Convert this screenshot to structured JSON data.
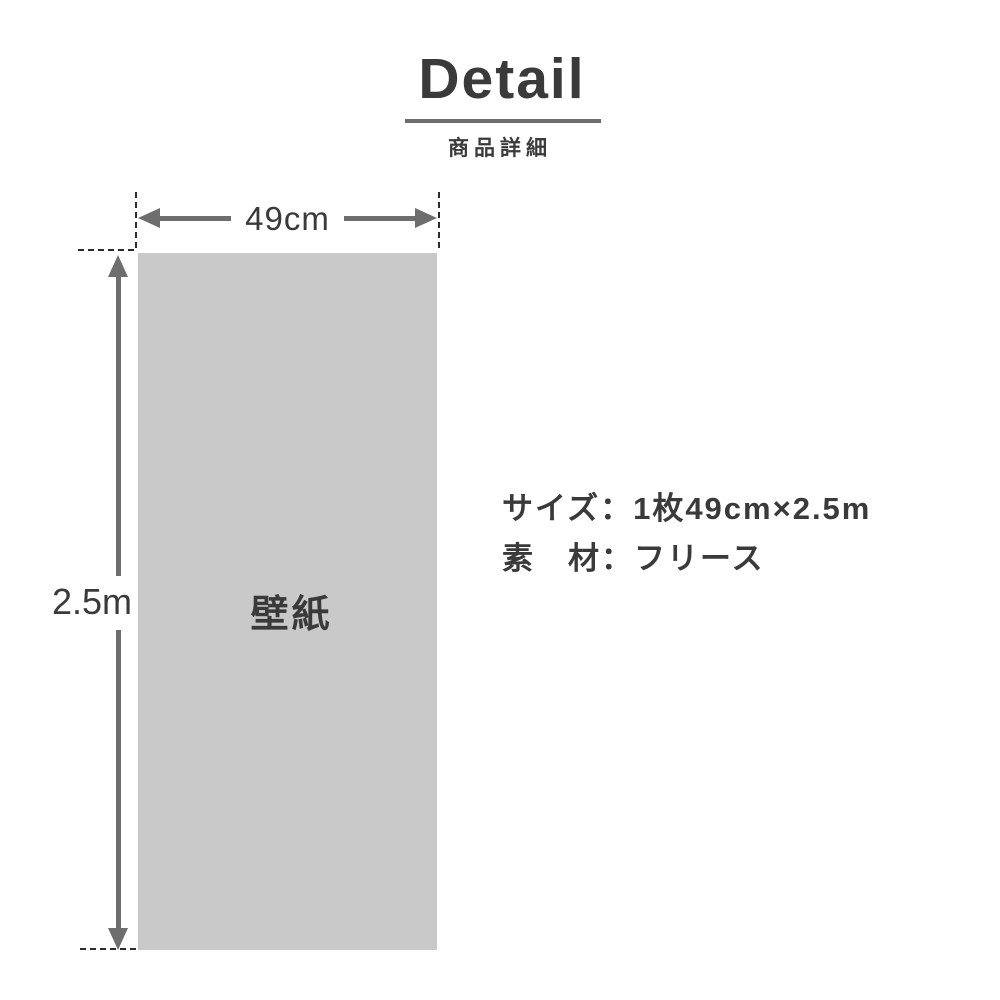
{
  "header": {
    "title": "Detail",
    "subtitle": "商品詳細"
  },
  "diagram": {
    "width_label": "49cm",
    "height_label": "2.5m",
    "panel_label": "壁紙"
  },
  "specs": {
    "rows": [
      {
        "label": "サイズ",
        "separator": "：",
        "value": "1枚49cm×2.5m"
      },
      {
        "label": "素　材",
        "separator": "：",
        "value": "フリース"
      }
    ]
  },
  "colors": {
    "text": "#3a3a3a",
    "arrow": "#6e6e6e",
    "panel_fill": "#c9c9c9",
    "dashed_line": "#2b2b2b",
    "background": "#ffffff"
  }
}
